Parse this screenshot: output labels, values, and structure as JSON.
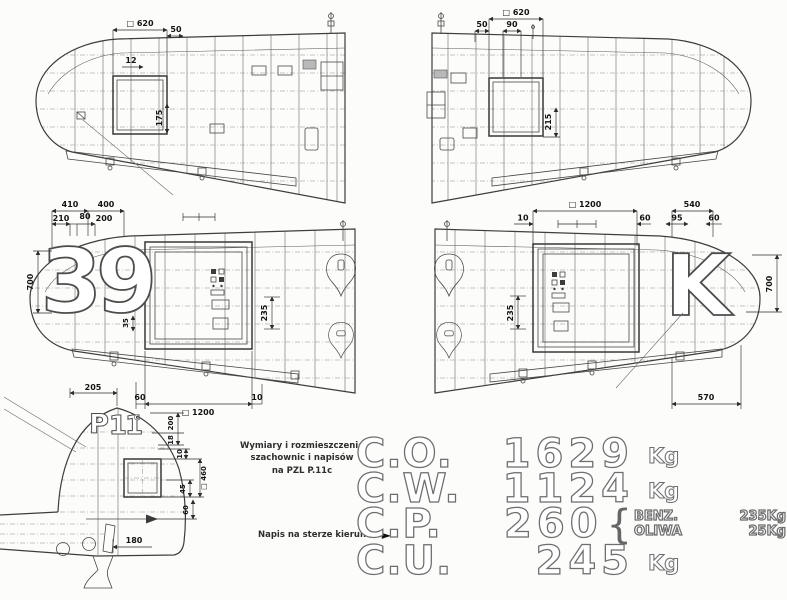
{
  "caption": {
    "line1": "Wymiary i rozmieszczenie",
    "line2": "szachownic i napisów",
    "line3": "na PZL P.11c"
  },
  "rudder_note": {
    "text": "Napis na sterze kierunku",
    "arrow": "►"
  },
  "panels": {
    "wing_top_left": {
      "dims": {
        "square620": "□ 620",
        "d50": "50",
        "d12": "12",
        "d175": "175"
      }
    },
    "wing_top_right": {
      "dims": {
        "square620": "□ 620",
        "d50": "50",
        "d90": "90",
        "d215": "215"
      }
    },
    "wing_bottom_left": {
      "marking": "39",
      "dims": {
        "d410": "410",
        "d400": "400",
        "d210": "210",
        "d80": "80",
        "d200": "200",
        "d700": "700",
        "d35": "35",
        "d235": "235",
        "d60": "60",
        "square1200": "□ 1200",
        "d10": "10"
      }
    },
    "wing_bottom_right": {
      "marking": "K",
      "dims": {
        "square1200": "□ 1200",
        "d10": "10",
        "d60a": "60",
        "d540": "540",
        "d95": "95",
        "d60b": "60",
        "d235": "235",
        "d700": "700",
        "d570": "570"
      }
    },
    "tail": {
      "marking_letter": "P",
      "marking_number": "11",
      "marking_suffix": "c",
      "dims": {
        "d205": "205",
        "d200": "200",
        "d18": "18",
        "d10": "10",
        "d45": "45",
        "square460": "□ 460",
        "d60": "60",
        "d180": "180"
      }
    }
  },
  "weights": {
    "rows": [
      {
        "label": "C.O.",
        "value": "1629",
        "unit": "Kg"
      },
      {
        "label": "C.W.",
        "value": "1124",
        "unit": "Kg"
      },
      {
        "label": "C.P.",
        "value": "260",
        "unit": "",
        "brace": "{",
        "details": [
          {
            "name": "BENZ.",
            "value": "235Kg"
          },
          {
            "name": "OLIWA",
            "value": "25Kg"
          }
        ]
      },
      {
        "label": "C.U.",
        "value": "245",
        "unit": "Kg"
      }
    ]
  }
}
